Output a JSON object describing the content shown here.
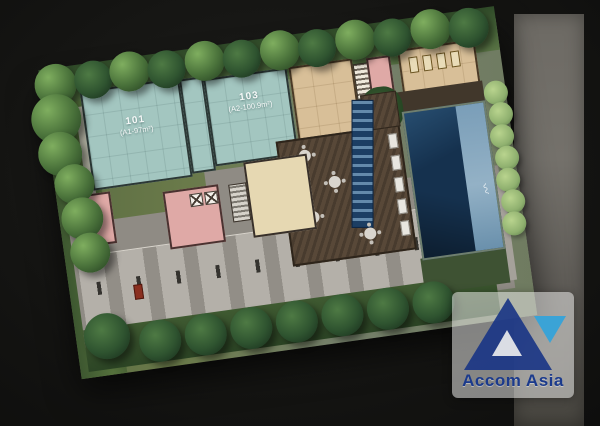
{
  "plan": {
    "units": [
      {
        "id": "101",
        "area_label": "(A1-97m²)"
      },
      {
        "id": "103",
        "area_label": "(A2-100.9m²)"
      }
    ]
  },
  "watermark": {
    "brand": "Accom Asia",
    "colors": {
      "primary": "#1b3a8c",
      "accent": "#3ba3d6"
    }
  },
  "palette": {
    "unit_teal": "#a3c6c0",
    "amenity_tan": "#d8bf98",
    "core_pink": "#dfa9a6",
    "lobby_cream": "#e6d8b2",
    "pool_deep": "#15314e",
    "pool_shallow": "#7fa3bd",
    "deck_brown": "#584838",
    "paving_gray": "#8f8b84"
  }
}
